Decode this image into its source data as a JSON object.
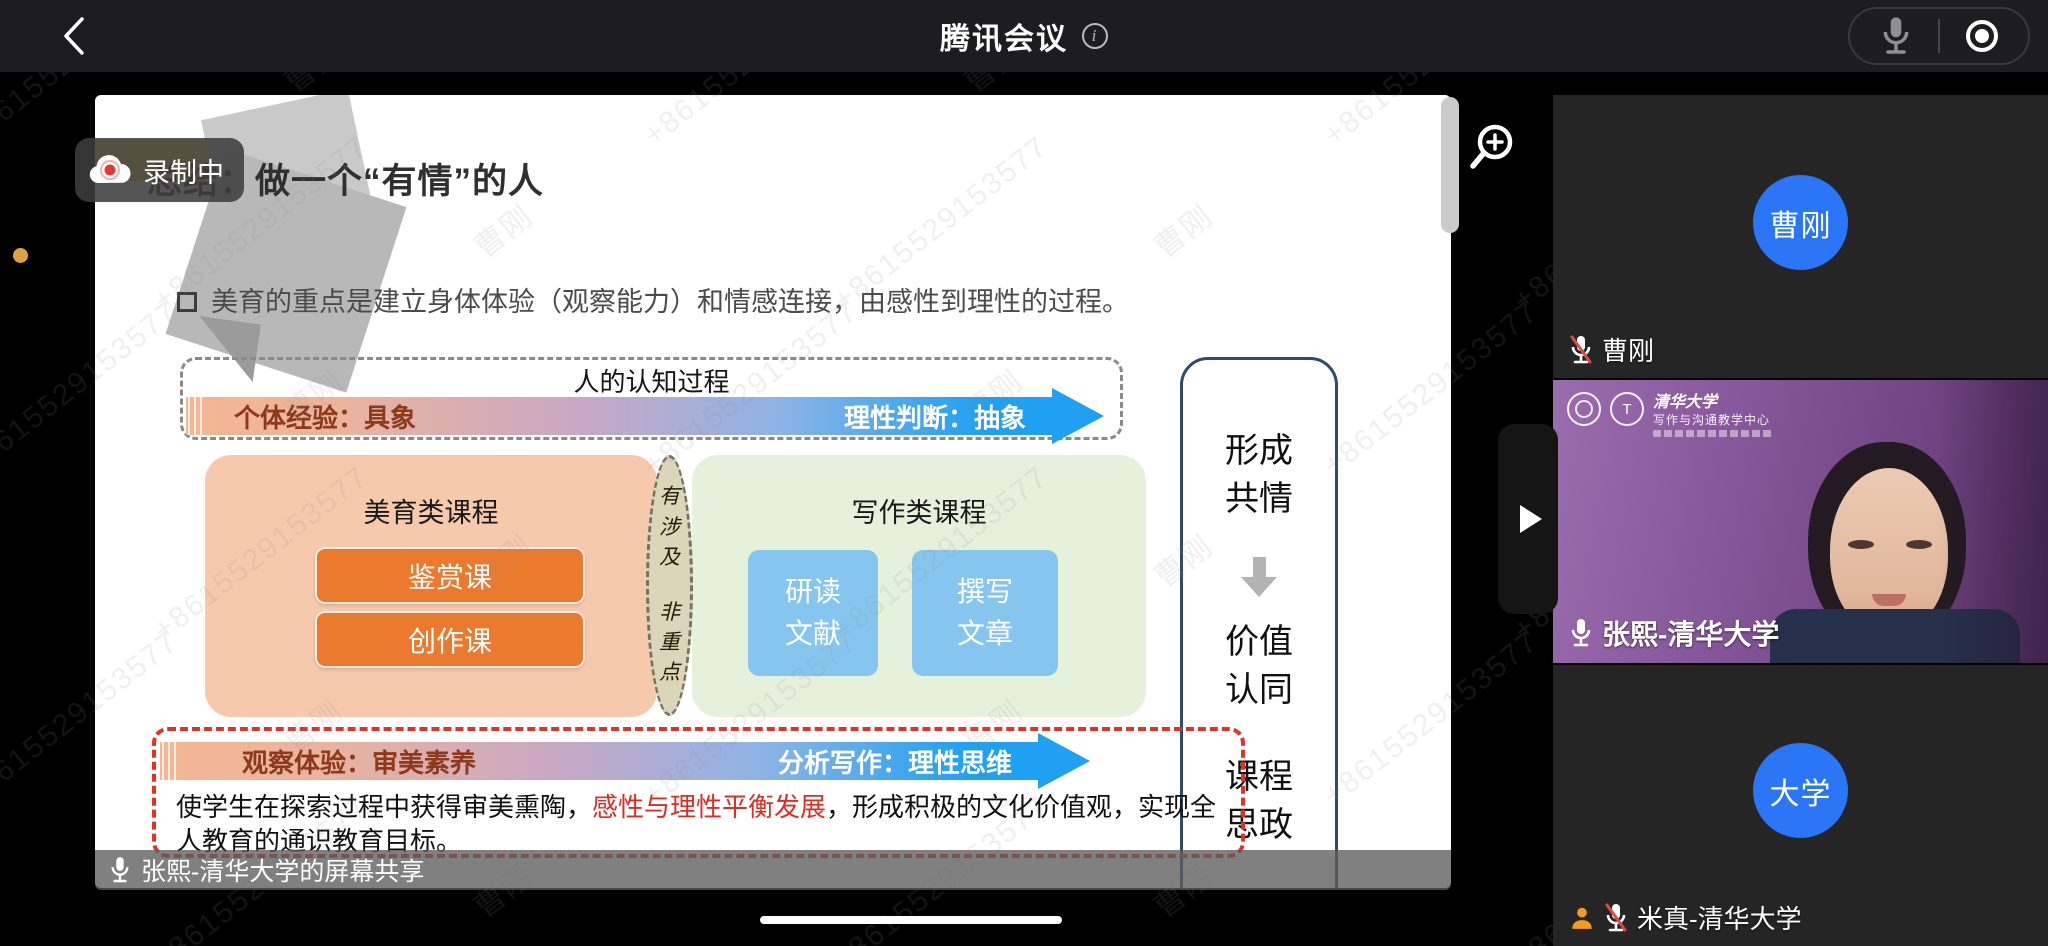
{
  "topbar": {
    "title": "腾讯会议"
  },
  "recording": {
    "label": "录制中"
  },
  "slide": {
    "title": "总结：做一个“有情”的人",
    "bullet": "美育的重点是建立身体体验（观察能力）和情感连接，由感性到理性的过程。",
    "cognition": {
      "title": "人的认知过程",
      "left": "个体经验：具象",
      "right": "理性判断：抽象"
    },
    "aesthetic": {
      "title": "美育类课程",
      "course1": "鉴赏课",
      "course2": "创作课"
    },
    "oval": {
      "top": "有涉及",
      "bottom": "非重点"
    },
    "writing": {
      "title": "写作类课程",
      "box1_line1": "研读",
      "box1_line2": "文献",
      "box2_line1": "撰写",
      "box2_line2": "文章"
    },
    "outcome": {
      "item1_line1": "形成",
      "item1_line2": "共情",
      "item2_line1": "价值",
      "item2_line2": "认同",
      "item3_line1": "课程",
      "item3_line2": "思政"
    },
    "bottom": {
      "left": "观察体验：审美素养",
      "right": "分析写作：理性思维",
      "text_pre": "使学生在探索过程中获得审美熏陶，",
      "text_highlight": "感性与理性平衡发展",
      "text_post": "，形成积极的文化价值观，实现全人教育的通识教育目标。"
    }
  },
  "share_bar": {
    "label": "张熙-清华大学的屏幕共享"
  },
  "participants": {
    "p1": {
      "name": "曹刚",
      "avatar": "曹刚"
    },
    "p2": {
      "name": "张熙-清华大学",
      "logo_title": "清华大学",
      "logo_sub": "写作与沟通教学中心"
    },
    "p3": {
      "name": "米真-清华大学",
      "avatar": "大学"
    }
  },
  "watermark": {
    "phone": "+8615529153577",
    "name": "曹刚"
  },
  "colors": {
    "avatar_blue": "#2b76f6",
    "course_orange": "#ec7a2e",
    "card_blue": "#86c6ee",
    "arrow_blue": "#1fa0f2",
    "alert_red": "#e53125",
    "record_red": "#e23b33",
    "slide_yellow": "#f8d456"
  }
}
